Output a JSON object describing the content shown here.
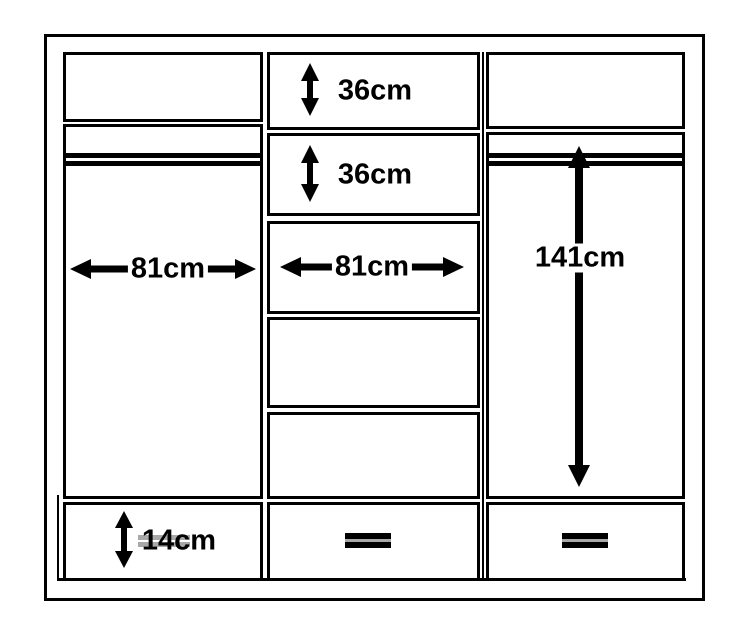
{
  "diagram": {
    "title": "wardrobe-dimension-diagram",
    "colors": {
      "line": "#000000",
      "background": "#ffffff",
      "handle_gray": "#a8a8a8"
    },
    "annotations": {
      "middle_top_drawer_height": {
        "text": "36cm",
        "arrow": "vertical-double"
      },
      "middle_second_drawer_height": {
        "text": "36cm",
        "arrow": "vertical-double"
      },
      "left_door_width": {
        "text": "81cm",
        "arrow": "horizontal-double"
      },
      "middle_section_width": {
        "text": "81cm",
        "arrow": "horizontal-double"
      },
      "right_hanging_height": {
        "text": "141cm",
        "arrow": "vertical-double"
      },
      "bottom_drawer_height": {
        "text": "14cm",
        "arrow": "vertical-double"
      }
    }
  }
}
